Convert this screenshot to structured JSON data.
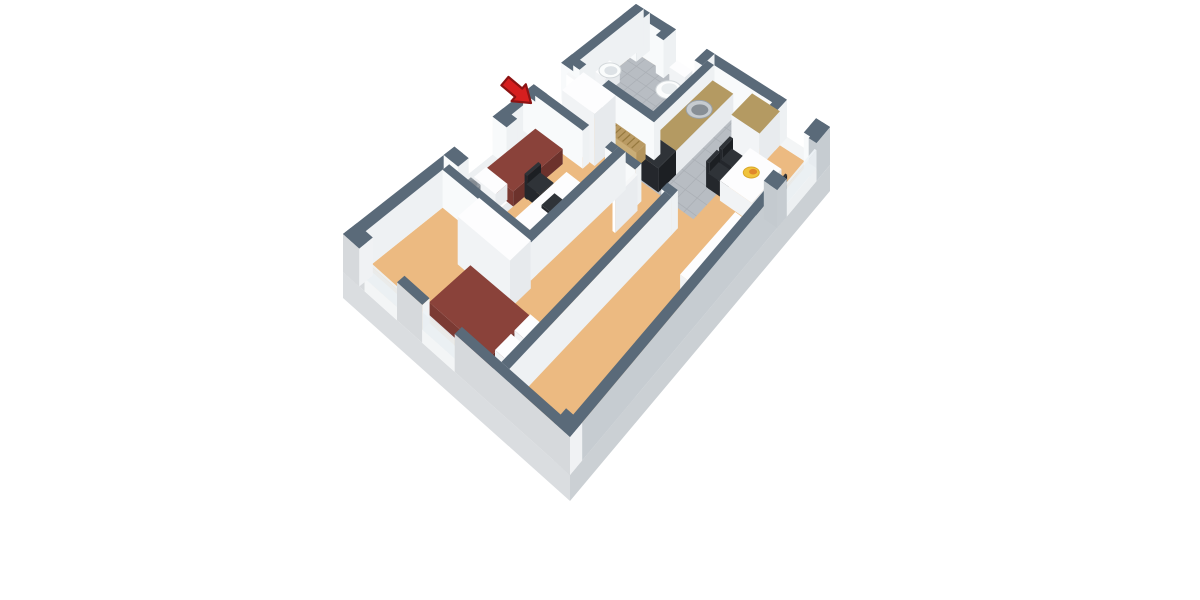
{
  "scene": {
    "kind": "floorplan-3d-render",
    "background": "#ffffff",
    "plan_width_m": 6.3,
    "plan_depth_m": 9.6
  },
  "palette": {
    "wall": {
      "top": "#5a6a79",
      "left": "#f8fafb",
      "right": "#eef1f3"
    },
    "wallSE": {
      "top": "#5a6a79",
      "left": "#c4cacf",
      "right": "#c6ccd1"
    },
    "wallSW": {
      "top": "#5a6a79",
      "left": "#d6d9dc",
      "right": "#f0f2f4"
    },
    "white": {
      "top": "#fdfdfe",
      "left": "#f1f3f5",
      "right": "#e7eaed"
    },
    "maroon": {
      "top": "#8a423a",
      "left": "#7b3a33",
      "right": "#6c322c"
    },
    "counter": {
      "top": "#b49a62",
      "left": "#f2f4f6",
      "right": "#e8ebee"
    },
    "wood": {
      "top": "#b99a63",
      "left": "#c9ad77",
      "right": "#b3945c"
    },
    "black": {
      "top": "#2f3338",
      "left": "#24272c",
      "right": "#1c1f23"
    },
    "gray": {
      "top": "#9199a0",
      "left": "#9ca3aa",
      "right": "#868d94"
    },
    "sill": {
      "top": "#ffffff",
      "left": "#f3f5f6",
      "right": "#edf0f2"
    },
    "glass": {
      "top": "#eef3f6",
      "left": "#e9eff2",
      "right": "#e9eff2"
    },
    "leaf": {
      "top": "#f6f7f8",
      "left": "#ffffff",
      "right": "#e9ecef"
    }
  },
  "colors": {
    "floorTan": "#ecba81",
    "tile": "#b8bdc3",
    "grout": "#a9aeb4",
    "plinthSE": "#cbd0d4",
    "plinthSW": "#dadde0",
    "arrowRed": "#d61f1f",
    "arrowDark": "#8c1313"
  },
  "objects": [
    {
      "name": "plinth-se",
      "kind": "face",
      "fill": "plinthSE",
      "pts": [
        [
          6.3,
          0,
          0
        ],
        [
          6.3,
          9.6,
          0
        ],
        [
          6.3,
          9.6,
          -26
        ],
        [
          6.3,
          0,
          -26
        ]
      ]
    },
    {
      "name": "plinth-sw",
      "kind": "face",
      "fill": "plinthSW",
      "pts": [
        [
          0,
          9.6,
          0
        ],
        [
          6.3,
          9.6,
          0
        ],
        [
          6.3,
          9.6,
          -26
        ],
        [
          0,
          9.6,
          -26
        ]
      ]
    },
    {
      "name": "floor-living",
      "kind": "floor",
      "c": "floorTan",
      "rect": [
        0.25,
        0.25,
        6.05,
        9.35
      ]
    },
    {
      "name": "floor-bathroom",
      "kind": "floor",
      "c": "tile",
      "rect": [
        0.25,
        0.25,
        2.55,
        2.1
      ]
    },
    {
      "name": "floor-bathroom-doorway",
      "kind": "floor",
      "c": "tile",
      "rect": [
        0.45,
        2.1,
        1.15,
        2.32
      ]
    },
    {
      "name": "bathroom-tile-grid",
      "kind": "grid",
      "rect": [
        0.25,
        0.25,
        2.55,
        2.1
      ],
      "step": 0.3,
      "stroke": "#a9aeb4"
    },
    {
      "name": "floor-kitchen",
      "kind": "floor",
      "c": "tile",
      "rect": [
        2.77,
        0.25,
        4.55,
        2.95
      ]
    },
    {
      "name": "kitchen-tile-grid",
      "kind": "grid",
      "rect": [
        2.77,
        0.25,
        4.55,
        2.95
      ],
      "step": 0.37,
      "stroke": "#a9aeb4"
    },
    {
      "name": "wall-ne-1",
      "kind": "box",
      "c": "wall",
      "rect": [
        0,
        0,
        1.3,
        0.25
      ],
      "h": 38
    },
    {
      "name": "bathroom-window-sill",
      "kind": "box",
      "c": "sill",
      "rect": [
        1.3,
        0,
        2.3,
        0.25
      ],
      "h": 13
    },
    {
      "name": "wall-ne-2",
      "kind": "box",
      "c": "wall",
      "rect": [
        2.3,
        0,
        4.9,
        0.25
      ],
      "h": 38
    },
    {
      "name": "kitchen-window-sill",
      "kind": "box",
      "c": "sill",
      "rect": [
        4.9,
        0,
        5.85,
        0.25
      ],
      "h": 13
    },
    {
      "name": "wall-ne-3",
      "kind": "box",
      "c": "wall",
      "rect": [
        5.85,
        0,
        6.3,
        0.25
      ],
      "h": 38
    },
    {
      "name": "pier-north-corner",
      "kind": "box",
      "c": "wall",
      "rect": [
        0,
        0,
        0.45,
        0.45
      ],
      "h": 38
    },
    {
      "name": "pier-ne-a",
      "kind": "box",
      "c": "wall",
      "rect": [
        1.05,
        0,
        1.3,
        0.42
      ],
      "h": 38
    },
    {
      "name": "pier-ne-b",
      "kind": "box",
      "c": "wall",
      "rect": [
        2.3,
        0,
        2.55,
        0.42
      ],
      "h": 38
    },
    {
      "name": "pier-ne-c",
      "kind": "box",
      "c": "wall",
      "rect": [
        4.65,
        0,
        4.9,
        0.42
      ],
      "h": 38
    },
    {
      "name": "pier-east-corner",
      "kind": "box",
      "c": "wall",
      "rect": [
        5.85,
        0,
        6.3,
        0.45
      ],
      "h": 38
    },
    {
      "name": "wall-nw-1",
      "kind": "box",
      "c": "wall",
      "rect": [
        0,
        0,
        0.25,
        2.45
      ],
      "h": 38
    },
    {
      "name": "entrance-threshold",
      "kind": "box",
      "c": "sill",
      "rect": [
        0,
        2.45,
        0.25,
        3.35
      ],
      "h": 2
    },
    {
      "name": "wall-nw-2",
      "kind": "box",
      "c": "wall",
      "rect": [
        0,
        3.35,
        0.25,
        4.7
      ],
      "h": 38
    },
    {
      "name": "bedroom1-window-sill",
      "kind": "box",
      "c": "sill",
      "rect": [
        0,
        4.7,
        0.25,
        5.95
      ],
      "h": 13
    },
    {
      "name": "wall-nw-3",
      "kind": "box",
      "c": "wall",
      "rect": [
        0,
        5.95,
        0.25,
        9.6
      ],
      "h": 38
    },
    {
      "name": "pier-nw-a",
      "kind": "box",
      "c": "wall",
      "rect": [
        0,
        2.1,
        0.42,
        2.45
      ],
      "h": 38
    },
    {
      "name": "pier-nw-b",
      "kind": "box",
      "c": "wall",
      "rect": [
        0,
        3.35,
        0.42,
        3.7
      ],
      "h": 38
    },
    {
      "name": "pier-nw-c",
      "kind": "box",
      "c": "wall",
      "rect": [
        0,
        4.35,
        0.42,
        4.7
      ],
      "h": 38
    },
    {
      "name": "pier-nw-d",
      "kind": "box",
      "c": "wall",
      "rect": [
        0,
        5.95,
        0.42,
        6.3
      ],
      "h": 38
    },
    {
      "name": "toilet-tank",
      "kind": "box",
      "c": "white",
      "rect": [
        1.6,
        0.28,
        2.1,
        0.54
      ],
      "h": 20
    },
    {
      "name": "toilet-bowl",
      "kind": "ellipse",
      "at": [
        1.85,
        0.82,
        10
      ],
      "rx": 13,
      "ry": 9,
      "fill": "#fcfdfd",
      "stroke": "#d3d8db",
      "sw": 1
    },
    {
      "name": "toilet-seat",
      "kind": "ellipse",
      "at": [
        1.85,
        0.8,
        10.5
      ],
      "rx": 8,
      "ry": 5.5,
      "fill": "#e9edef"
    },
    {
      "name": "bathroom-sink-pedestal",
      "kind": "box",
      "c": "white",
      "rect": [
        0.28,
        1.15,
        0.6,
        1.62
      ],
      "h": 15
    },
    {
      "name": "bathroom-sink-basin",
      "kind": "ellipse",
      "at": [
        0.52,
        1.39,
        16
      ],
      "rx": 11,
      "ry": 7.5,
      "fill": "#fafcfc",
      "stroke": "#d3d8db",
      "sw": 1
    },
    {
      "name": "bathroom-sink-bowl",
      "kind": "ellipse",
      "at": [
        0.55,
        1.39,
        16.5
      ],
      "rx": 6.5,
      "ry": 4.5,
      "fill": "#dde2e6"
    },
    {
      "name": "wall-bathroom-kitchen",
      "kind": "box",
      "c": "wall",
      "rect": [
        2.55,
        0.25,
        2.77,
        2.32
      ],
      "h": 38
    },
    {
      "name": "kitchen-counter",
      "kind": "box",
      "c": "counter",
      "rect": [
        2.77,
        0.3,
        3.44,
        2.3
      ],
      "h": 24
    },
    {
      "name": "kitchen-sink-rim",
      "kind": "ellipse",
      "at": [
        3.1,
        1.12,
        24.5
      ],
      "rx": 13,
      "ry": 9,
      "fill": "#c6cbd0",
      "stroke": "#9aa1a7",
      "sw": 1
    },
    {
      "name": "kitchen-sink-basin",
      "kind": "ellipse",
      "at": [
        3.12,
        1.12,
        24.5
      ],
      "rx": 8.5,
      "ry": 5.5,
      "fill": "#878e95"
    },
    {
      "name": "stove",
      "kind": "box",
      "c": "black",
      "rect": [
        2.77,
        2.3,
        3.44,
        2.92
      ],
      "h": 24
    },
    {
      "name": "kitchen-tall-cabinet",
      "kind": "box",
      "c": "counter",
      "rect": [
        4.0,
        0.25,
        4.9,
        0.98
      ],
      "h": 34
    },
    {
      "name": "wall-bathroom-south-1",
      "kind": "box",
      "c": "wall",
      "rect": [
        0.25,
        2.1,
        0.45,
        2.32
      ],
      "h": 38
    },
    {
      "name": "wall-bathroom-south-2",
      "kind": "box",
      "c": "wall",
      "rect": [
        1.15,
        2.1,
        2.77,
        2.32
      ],
      "h": 38
    },
    {
      "name": "hall-bench",
      "kind": "box",
      "c": "wood",
      "rect": [
        1.55,
        2.42,
        2.6,
        2.74
      ],
      "h": 15
    },
    {
      "name": "hall-bench-slats",
      "kind": "slats",
      "rect": [
        1.58,
        2.45,
        2.57,
        2.71
      ],
      "z": 15,
      "count": 7,
      "stroke": "#96793f"
    },
    {
      "name": "entrance-door-leaf",
      "kind": "box",
      "c": "leaf",
      "rect": [
        0.28,
        2.5,
        1.02,
        2.58
      ],
      "h": 36
    },
    {
      "name": "hall-wardrobe",
      "kind": "box",
      "c": "white",
      "rect": [
        0.85,
        2.62,
        1.85,
        3.33
      ],
      "h": 52
    },
    {
      "name": "dining-chair-1-back",
      "kind": "box",
      "c": "black",
      "rect": [
        4.22,
        1.28,
        4.32,
        1.66
      ],
      "h": 26
    },
    {
      "name": "dining-chair-1",
      "kind": "box",
      "c": "black",
      "rect": [
        4.28,
        1.28,
        4.66,
        1.66
      ],
      "h": 15
    },
    {
      "name": "dining-chair-2-back",
      "kind": "box",
      "c": "black",
      "rect": [
        4.22,
        1.74,
        4.32,
        2.12
      ],
      "h": 26
    },
    {
      "name": "dining-chair-2",
      "kind": "box",
      "c": "black",
      "rect": [
        4.28,
        1.74,
        4.66,
        2.12
      ],
      "h": 15
    },
    {
      "name": "dining-table",
      "kind": "box",
      "c": "white",
      "rect": [
        4.72,
        1.12,
        5.72,
        2.2
      ],
      "h": 20
    },
    {
      "name": "fruit-plate",
      "kind": "ellipse",
      "at": [
        5.2,
        1.62,
        21
      ],
      "rx": 8,
      "ry": 5.5,
      "fill": "#f0c33c",
      "stroke": "#d9a82a",
      "sw": 1
    },
    {
      "name": "fruit",
      "kind": "ellipse",
      "at": [
        5.24,
        1.6,
        22
      ],
      "rx": 4,
      "ry": 2.8,
      "fill": "#e0872b"
    },
    {
      "name": "dining-chair-3",
      "kind": "box",
      "c": "black",
      "rect": [
        5.78,
        1.28,
        6.02,
        1.66
      ],
      "h": 15
    },
    {
      "name": "dining-chair-3-back",
      "kind": "box",
      "c": "black",
      "rect": [
        5.98,
        1.28,
        6.04,
        1.66
      ],
      "h": 26
    },
    {
      "name": "dining-chair-4",
      "kind": "box",
      "c": "black",
      "rect": [
        5.78,
        1.74,
        6.02,
        2.12
      ],
      "h": 15
    },
    {
      "name": "dining-chair-4-back",
      "kind": "box",
      "c": "black",
      "rect": [
        5.98,
        1.74,
        6.04,
        2.12
      ],
      "h": 26
    },
    {
      "name": "wall-hall-bedroom2-1",
      "kind": "box",
      "c": "wall",
      "rect": [
        2.82,
        3.35,
        3.3,
        3.57
      ],
      "h": 38
    },
    {
      "name": "wall-hall-bedroom2-2",
      "kind": "box",
      "c": "wall",
      "rect": [
        4.1,
        3.35,
        4.42,
        3.57
      ],
      "h": 38
    },
    {
      "name": "bedroom2-door-leaf",
      "kind": "box",
      "c": "leaf",
      "rect": [
        3.32,
        3.6,
        3.4,
        4.38
      ],
      "h": 36
    },
    {
      "name": "wall-bedroom1-north-1",
      "kind": "box",
      "c": "wall",
      "rect": [
        0.25,
        3.35,
        1.7,
        3.57
      ],
      "h": 38
    },
    {
      "name": "wall-bedroom1-north-2",
      "kind": "box",
      "c": "wall",
      "rect": [
        2.38,
        3.35,
        2.6,
        3.57
      ],
      "h": 38
    },
    {
      "name": "bed1-base",
      "kind": "box",
      "c": "white",
      "rect": [
        0.45,
        3.78,
        1.28,
        5.98
      ],
      "h": 9
    },
    {
      "name": "bed1-cover",
      "kind": "box",
      "c": "maroon",
      "rect": [
        0.45,
        3.78,
        1.28,
        5.44
      ],
      "h": 15
    },
    {
      "name": "bed1-pillow",
      "kind": "box",
      "c": "white",
      "rect": [
        0.55,
        5.52,
        1.18,
        5.92
      ],
      "h": 16,
      "z0": 6
    },
    {
      "name": "bed1-nightstand",
      "kind": "box",
      "c": "white",
      "rect": [
        0.45,
        6.04,
        1.02,
        6.36
      ],
      "h": 14
    },
    {
      "name": "bed1-lamp",
      "kind": "box",
      "c": "gray",
      "rect": [
        0.6,
        6.08,
        0.88,
        6.3
      ],
      "h": 13,
      "z0": 14
    },
    {
      "name": "bed1-lamp-top",
      "kind": "ellipse",
      "at": [
        0.74,
        6.19,
        27
      ],
      "rx": 5,
      "ry": 3.5,
      "fill": "#858c93"
    },
    {
      "name": "desk-chair-back",
      "kind": "box",
      "c": "black",
      "rect": [
        1.3,
        4.62,
        1.38,
        5.08
      ],
      "h": 24
    },
    {
      "name": "desk-chair",
      "kind": "box",
      "c": "black",
      "rect": [
        1.34,
        4.6,
        1.74,
        5.06
      ],
      "h": 14
    },
    {
      "name": "desk",
      "kind": "box",
      "c": "white",
      "rect": [
        1.88,
        4.32,
        2.5,
        6.06
      ],
      "h": 21
    },
    {
      "name": "laptop",
      "kind": "box",
      "c": "black",
      "rect": [
        2.12,
        5.0,
        2.4,
        5.44
      ],
      "h": 3,
      "z0": 21
    },
    {
      "name": "wall-bedroom1-east",
      "kind": "box",
      "c": "wall",
      "rect": [
        2.6,
        3.35,
        2.82,
        6.62
      ],
      "h": 38
    },
    {
      "name": "wall-bedroom1-south",
      "kind": "box",
      "c": "wall",
      "rect": [
        0.25,
        6.4,
        2.82,
        6.62
      ],
      "h": 38
    },
    {
      "name": "bedroom2-wardrobe",
      "kind": "box",
      "c": "white",
      "rect": [
        1.45,
        6.78,
        2.95,
        7.5
      ],
      "h": 48
    },
    {
      "name": "bed2-base",
      "kind": "box",
      "c": "white",
      "rect": [
        1.9,
        7.6,
        4.18,
        9.0
      ],
      "h": 9
    },
    {
      "name": "bed2-cover",
      "kind": "box",
      "c": "maroon",
      "rect": [
        1.9,
        7.6,
        3.62,
        9.0
      ],
      "h": 15
    },
    {
      "name": "bed2-pillow-1",
      "kind": "box",
      "c": "white",
      "rect": [
        3.68,
        7.68,
        4.14,
        8.24
      ],
      "h": 15,
      "z0": 6
    },
    {
      "name": "bed2-pillow-2",
      "kind": "box",
      "c": "white",
      "rect": [
        3.68,
        8.36,
        4.14,
        8.92
      ],
      "h": 15,
      "z0": 6
    },
    {
      "name": "wall-bedroom2-east",
      "kind": "box",
      "c": "wall",
      "rect": [
        4.2,
        3.57,
        4.42,
        9.35
      ],
      "h": 38
    },
    {
      "name": "sofa",
      "kind": "box",
      "c": "white",
      "rect": [
        5.5,
        2.55,
        6.05,
        4.55
      ],
      "h": 17
    },
    {
      "name": "wall-se-1",
      "kind": "box",
      "c": "wallSE",
      "rect": [
        6.05,
        0,
        6.3,
        0.5
      ],
      "h": 38
    },
    {
      "name": "living-window-sill",
      "kind": "box",
      "c": "sill",
      "rect": [
        6.05,
        0.5,
        6.3,
        1.6
      ],
      "h": 13
    },
    {
      "name": "living-window-glass",
      "kind": "box",
      "c": "glass",
      "rect": [
        6.24,
        0.5,
        6.3,
        1.6
      ],
      "h": 18,
      "z0": 13,
      "opacity": 0.93
    },
    {
      "name": "wall-se-2",
      "kind": "box",
      "c": "wallSE",
      "rect": [
        6.05,
        1.6,
        6.3,
        9.6
      ],
      "h": 38
    },
    {
      "name": "pier-se-a",
      "kind": "box",
      "c": "wallSE",
      "rect": [
        5.88,
        1.6,
        6.3,
        1.95
      ],
      "h": 38
    },
    {
      "name": "wall-sw-1",
      "kind": "box",
      "c": "wallSW",
      "rect": [
        0,
        9.35,
        0.6,
        9.6
      ],
      "h": 38
    },
    {
      "name": "bedroom2-window-1-sill",
      "kind": "box",
      "c": "sill",
      "rect": [
        0.6,
        9.35,
        1.5,
        9.6
      ],
      "h": 13
    },
    {
      "name": "bedroom2-window-1-glass",
      "kind": "box",
      "c": "glass",
      "rect": [
        0.6,
        9.54,
        1.5,
        9.6
      ],
      "h": 18,
      "z0": 13,
      "opacity": 0.93
    },
    {
      "name": "wall-sw-2",
      "kind": "box",
      "c": "wallSW",
      "rect": [
        1.5,
        9.35,
        2.2,
        9.6
      ],
      "h": 38
    },
    {
      "name": "bedroom2-window-2-sill",
      "kind": "box",
      "c": "sill",
      "rect": [
        2.2,
        9.35,
        3.1,
        9.6
      ],
      "h": 13
    },
    {
      "name": "bedroom2-window-2-glass",
      "kind": "box",
      "c": "glass",
      "rect": [
        2.2,
        9.54,
        3.1,
        9.6
      ],
      "h": 18,
      "z0": 13,
      "opacity": 0.93
    },
    {
      "name": "wall-sw-3",
      "kind": "box",
      "c": "wallSW",
      "rect": [
        3.1,
        9.35,
        6.3,
        9.6
      ],
      "h": 38
    },
    {
      "name": "pier-west-corner",
      "kind": "box",
      "c": "wallSW",
      "rect": [
        0,
        9.15,
        0.45,
        9.6
      ],
      "h": 38
    },
    {
      "name": "pier-south-corner",
      "kind": "box",
      "c": "wallSW",
      "rect": [
        5.85,
        9.15,
        6.3,
        9.6
      ],
      "h": 38
    },
    {
      "name": "entrance-arrow",
      "kind": "arrow",
      "fill": "#d61f1f",
      "stroke": "#8c1313",
      "points": [
        [
          531,
          103
        ],
        [
          525.8,
          84.3
        ],
        [
          522.2,
          88.5
        ],
        [
          508.4,
          76.9
        ],
        [
          501.4,
          85.3
        ],
        [
          515.2,
          96.9
        ],
        [
          511.6,
          101.1
        ]
      ]
    }
  ]
}
